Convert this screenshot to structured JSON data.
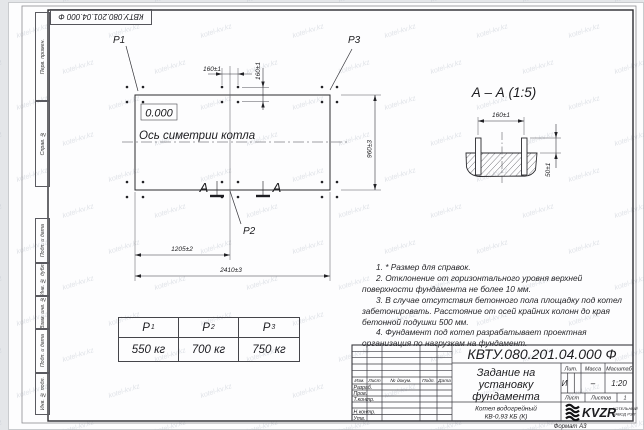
{
  "watermark": {
    "text": "kotel-kv.kz"
  },
  "top_stamp": {
    "designation": "КВТУ.080.201.04.000 Ф"
  },
  "side_stamps": {
    "perv_primen": "Перв. примен.",
    "sprav_no": "Справ. №",
    "podp_data_1": "Подп. и дата",
    "inv_dubl": "Инв. № дубл.",
    "vzam_inv": "Взам. инв. №",
    "podp_data_2": "Подп. и дата",
    "inv_podl": "Инв. № подл."
  },
  "plan": {
    "p1": "P1",
    "p2": "P2",
    "p3": "P3",
    "elevation": "0.000",
    "axis_label": "Ось симетрии котла",
    "dim_bolt_h": "160±1",
    "dim_bolt_v": "160±1",
    "dim_width": "960±3",
    "dim_half": "1205±2",
    "dim_full": "2410±3",
    "section_letter_left": "А",
    "section_letter_right": "А"
  },
  "section_view": {
    "title": "А – А (1:5)",
    "dim_bolts": "160±1",
    "dim_protrusion": "50±1"
  },
  "load_table": {
    "columns": [
      {
        "symbol": "P",
        "sub": "1",
        "value": "550 кг"
      },
      {
        "symbol": "P",
        "sub": "2",
        "value": "700 кг"
      },
      {
        "symbol": "P",
        "sub": "3",
        "value": "750 кг"
      }
    ]
  },
  "notes": [
    "1. * Размер для справок.",
    "2. Отклонение от горизонтального уровня верхней поверхности фундамента не более 10 мм.",
    "3. В случае отсутствия бетонного пола площадку под котел забетонировать. Расстояние от осей крайних колонн до края бетонной подушки 500 мм.",
    "4. Фундамент под котел разрабатывает проектная организация по нагрузкам на фундамент."
  ],
  "title_block": {
    "designation": "КВТУ.080.201.04.000 Ф",
    "doc_title_line1": "Задание на",
    "doc_title_line2": "установку",
    "doc_title_line3": "фундамента",
    "product_line1": "Котел водогрейный",
    "product_line2": "КВ-0,93 КБ (К)",
    "col_izm": "Изм.",
    "col_list": "Лист",
    "col_dokum": "№ докум.",
    "col_podp": "Подп.",
    "col_data": "Дата",
    "role_razrab": "Разраб.",
    "role_prov": "Пров.",
    "role_tkontr": "Т.контр.",
    "role_nkontr": "Н.контр.",
    "role_utv": "Утв.",
    "lit_header": "Лит.",
    "mass_header": "Масса",
    "scale_header": "Масштаб",
    "lit_value": "И",
    "mass_value": "–",
    "scale_value": "1:20",
    "sheet_label": "Лист",
    "sheets_label": "Листов",
    "sheets_value": "1",
    "logo_name": "KVZR",
    "logo_sub1": "КОТЕЛЬНЫЙ",
    "logo_sub2": "ЗАВОД РЭП",
    "format_label": "Формат А3"
  }
}
